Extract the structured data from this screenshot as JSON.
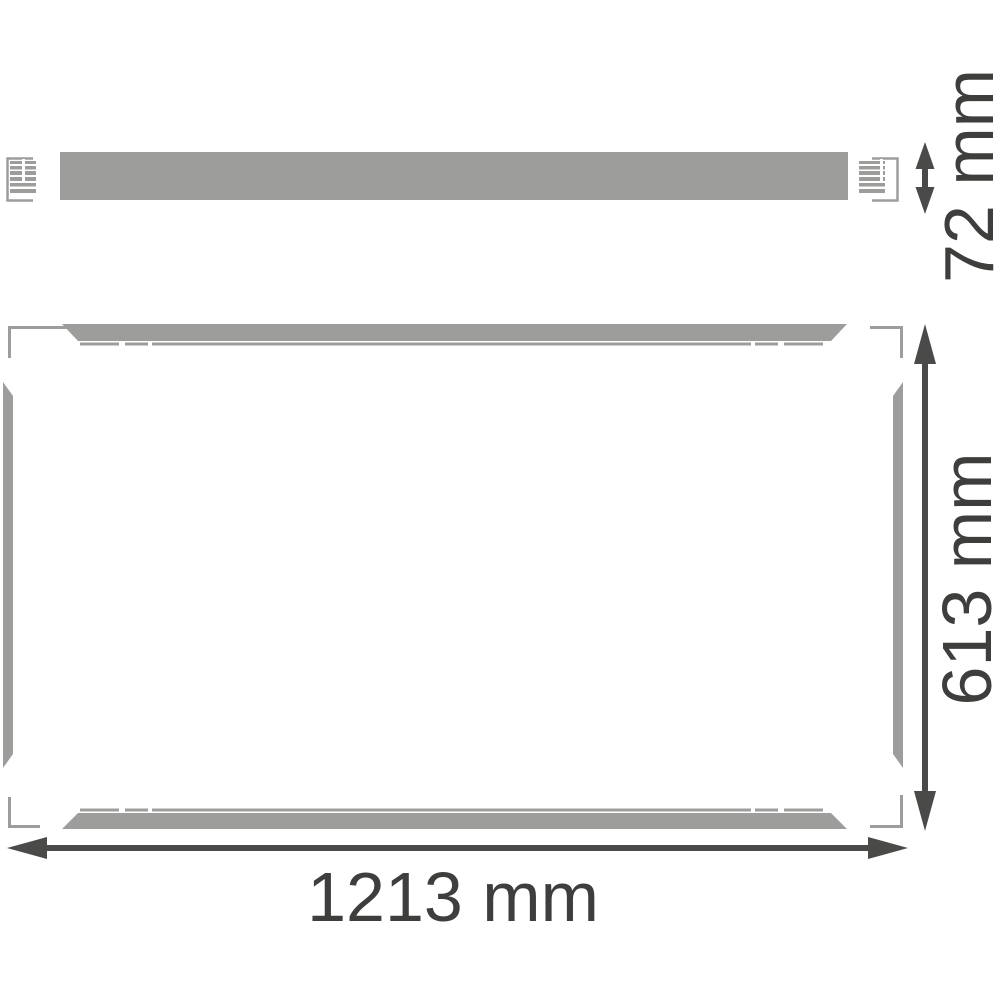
{
  "drawing": {
    "type": "technical-dimension-drawing",
    "views": {
      "side_view": {
        "description": "side profile of luminaire surface-mount frame rail with end clips",
        "height_label": "72 mm",
        "height_mm": 72
      },
      "front_view": {
        "description": "front view of rectangular surface-mount frame with four rails and corner brackets",
        "width_label": "1213 mm",
        "width_mm": 1213,
        "height_label": "613 mm",
        "height_mm": 613
      }
    },
    "colors": {
      "frame_gray": "#9d9d9c",
      "dimension_arrow": "#4a4a49",
      "dimension_text": "#3e3e3d",
      "background": "#ffffff"
    }
  }
}
